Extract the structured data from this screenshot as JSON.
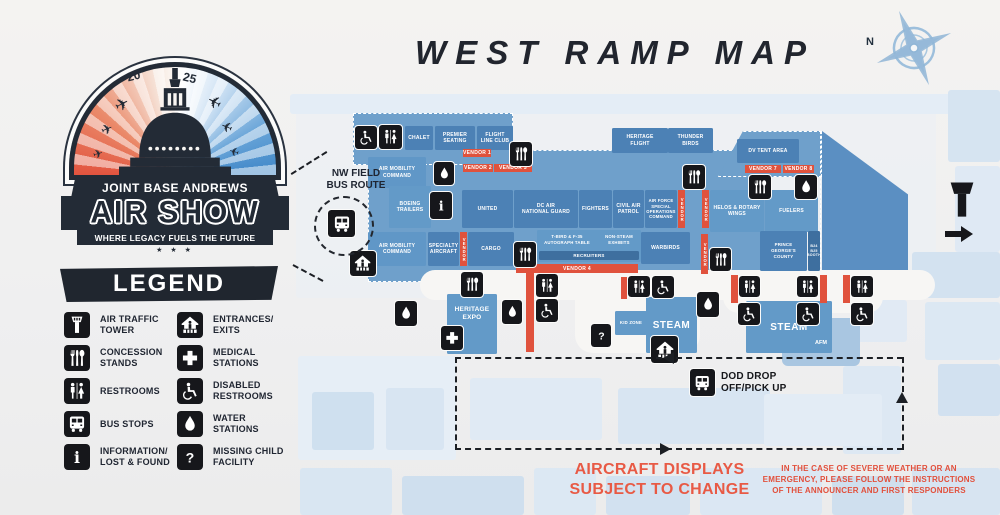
{
  "colors": {
    "accent_red": "#e0523d",
    "map_blue": "#4c81b5",
    "ramp_blue": "#6fa0cb",
    "ink": "#16171b",
    "note_red": "#e85a45"
  },
  "logo": {
    "year_left": "20",
    "year_right": "25",
    "name_line": "JOINT BASE ANDREWS",
    "title": "AIR SHOW",
    "tagline": "WHERE LEGACY FUELS THE FUTURE",
    "stars": "★ ★ ★"
  },
  "header": {
    "title": "WEST RAMP MAP"
  },
  "compass": {
    "north": "N"
  },
  "nw_route": {
    "label": "NW FIELD\nBUS ROUTE"
  },
  "legend": {
    "title": "LEGEND",
    "items": [
      {
        "icon": "air-traffic-tower",
        "label": "AIR TRAFFIC\nTOWER"
      },
      {
        "icon": "concession-stands",
        "label": "CONCESSION\nSTANDS"
      },
      {
        "icon": "restrooms",
        "label": "RESTROOMS"
      },
      {
        "icon": "bus-stops",
        "label": "BUS STOPS"
      },
      {
        "icon": "information-lost-found",
        "label": "INFORMATION/\nLOST & FOUND"
      },
      {
        "icon": "entrances-exits",
        "label": "ENTRANCES/\nEXITS"
      },
      {
        "icon": "medical-stations",
        "label": "MEDICAL\nSTATIONS"
      },
      {
        "icon": "disabled-restrooms",
        "label": "DISABLED\nRESTROOMS"
      },
      {
        "icon": "water-stations",
        "label": "WATER\nSTATIONS"
      },
      {
        "icon": "missing-child-facility",
        "label": "MISSING CHILD\nFACILITY"
      }
    ]
  },
  "map": {
    "chalet": "CHALET",
    "premier_seating": "PREMIER\nSEATING",
    "flight_line_club": "FLIGHT\nLINE CLUB",
    "heritage_flight": "HERITAGE\nFLIGHT",
    "thunderbirds": "THUNDER\nBIRDS",
    "dv_tent_area": "DV TENT AREA",
    "air_mobility_command_1": "AIR MOBILITY\nCOMMAND",
    "boeing_trailers": "BOEING\nTRAILERS",
    "united": "UNITED",
    "dc_air_national_guard": "DC AIR\nNATIONAL GUARD",
    "fighters": "FIGHTERS",
    "civil_air_patrol": "CIVIL AIR\nPATROL",
    "af_special_ops": "AIR FORCE\nSPECIAL\nOPERATIONS\nCOMMAND",
    "helos_rotary_wings": "HELOS & ROTARY\nWINGS",
    "fuelers": "FUELERS",
    "air_mobility_command_2": "AIR MOBILITY\nCOMMAND",
    "specialty_aircraft": "SPECIALTY\nAIRCRAFT",
    "cargo": "CARGO",
    "autograph_table": "T-BIRD & F-35\nAUTOGRAPH TABLE",
    "non_steam_exhibits": "NON-STEAM\nEXHIBITS",
    "recruiters": "RECRUITERS",
    "warbirds": "WARBIRDS",
    "prince_georges_county": "PRINCE\nGEORGE'S\nCOUNTY",
    "booth": "B24\nB25\nBOOTH",
    "heritage_expo": "HERITAGE\nEXPO",
    "kid_zone": "KID ZONE",
    "steam_1": "STEAM",
    "steam_2": "STEAM",
    "afm": "AFM"
  },
  "vendors": {
    "v1": "VENDOR 1",
    "v2": "VENDOR 2",
    "v3": "VENDOR 3",
    "v4": "VENDOR 4",
    "v7": "VENDOR 7",
    "v8": "VENDOR 8",
    "vertical": "VENDOR"
  },
  "notes": {
    "dod": "DOD DROP\nOFF/PICK UP",
    "aircraft_displays": "AIRCRAFT DISPLAYS\nSUBJECT TO CHANGE",
    "weather": "IN THE CASE OF SEVERE WEATHER OR AN EMERGENCY, PLEASE FOLLOW THE INSTRUCTIONS OF THE ANNOUNCER AND FIRST RESPONDERS"
  }
}
